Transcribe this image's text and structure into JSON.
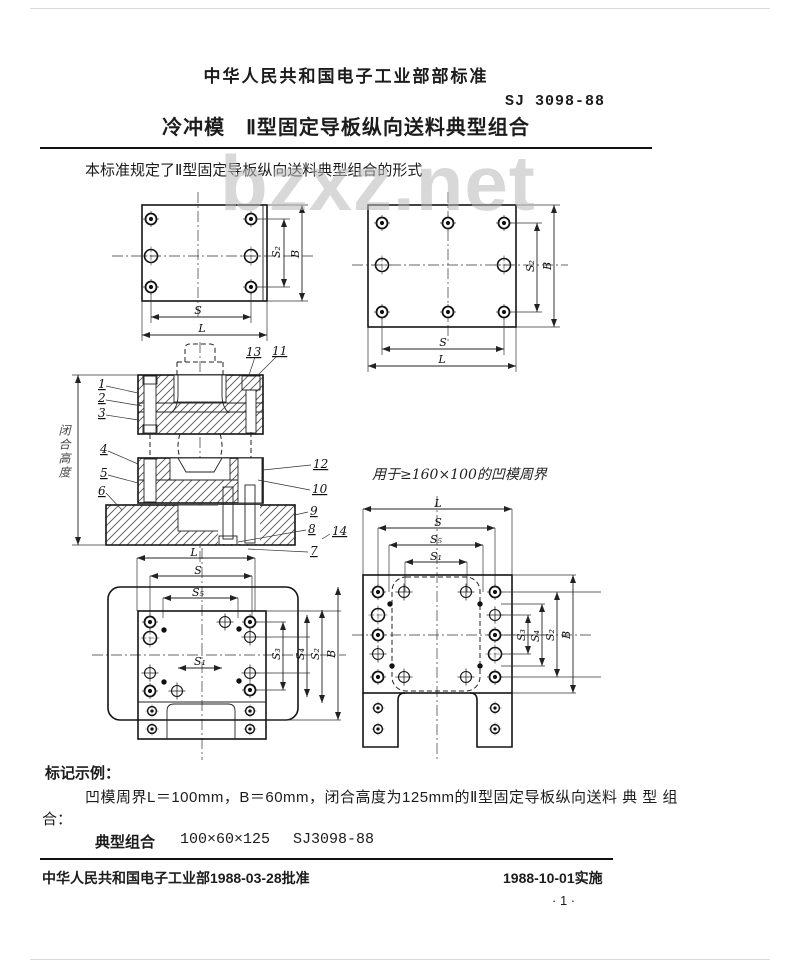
{
  "header": {
    "org_standard": "中华人民共和国电子工业部部标准",
    "standard_no": "SJ 3098-88",
    "title": "冷冲模　Ⅱ型固定导板纵向送料典型组合",
    "scope": "本标准规定了Ⅱ型固定导板纵向送料典型组合的形式"
  },
  "watermark": "bzxz.net",
  "drawings": {
    "closed_height_label": "闭合高度",
    "note": "用于≥160×100的凹模周界",
    "dims": {
      "L": "L",
      "S": "S",
      "B": "B",
      "S1": "S₁",
      "S2": "S₂",
      "S3": "S₃",
      "S4": "S₄",
      "S5": "S₅"
    },
    "parts": {
      "p1": "1",
      "p2": "2",
      "p3": "3",
      "p4": "4",
      "p5": "5",
      "p6": "6",
      "p7": "7",
      "p8": "8",
      "p9": "9",
      "p10": "10",
      "p11": "11",
      "p12": "12",
      "p13": "13",
      "p14": "14"
    }
  },
  "marking_example": {
    "heading": "标记示例：",
    "body_line1": "凹模周界L＝100mm，B＝60mm，闭合高度为125mm的Ⅱ型固定导板纵向送料 典 型 组",
    "body_line2": "合：",
    "designation_label": "典型组合",
    "designation_size": "100×60×125",
    "designation_std": "SJ3098-88"
  },
  "footer": {
    "approval": "中华人民共和国电子工业部1988-03-28批准",
    "implementation": "1988-10-01实施",
    "page_number": "· 1 ·"
  }
}
